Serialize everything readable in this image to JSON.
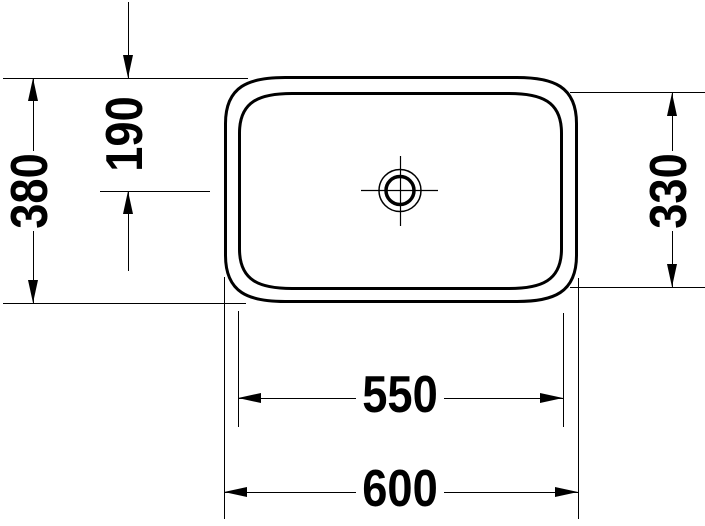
{
  "colors": {
    "line": "#000000",
    "background": "#ffffff"
  },
  "dimensions": {
    "overall_width": "600",
    "basin_inner_width": "550",
    "overall_depth": "380",
    "basin_inner_depth": "330",
    "drain_center_offset": "190"
  }
}
